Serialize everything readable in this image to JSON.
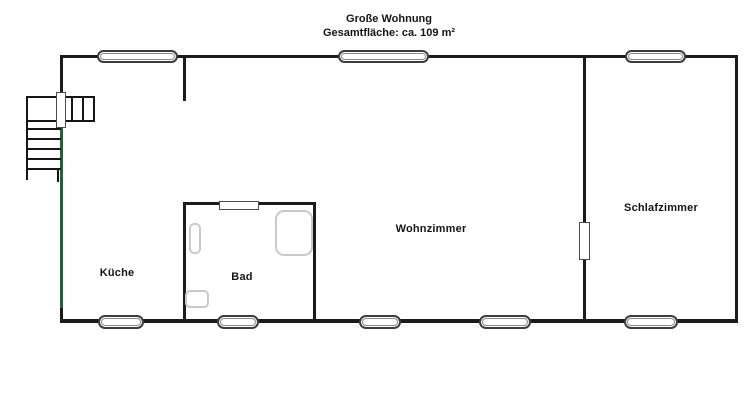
{
  "title": {
    "line1": "Große Wohnung",
    "line2": "Gesamtfläche: ca. 109 m²"
  },
  "rooms": {
    "kitchen": {
      "label": "Küche"
    },
    "bathroom": {
      "label": "Bad"
    },
    "living_room": {
      "label": "Wohnzimmer"
    },
    "bedroom": {
      "label": "Schlafzimmer"
    }
  },
  "colors": {
    "wall": "#1b1b1b",
    "left_wall_accent": "#2d5c3e",
    "fixture_outline": "#c9c9c9",
    "background": "#ffffff"
  }
}
